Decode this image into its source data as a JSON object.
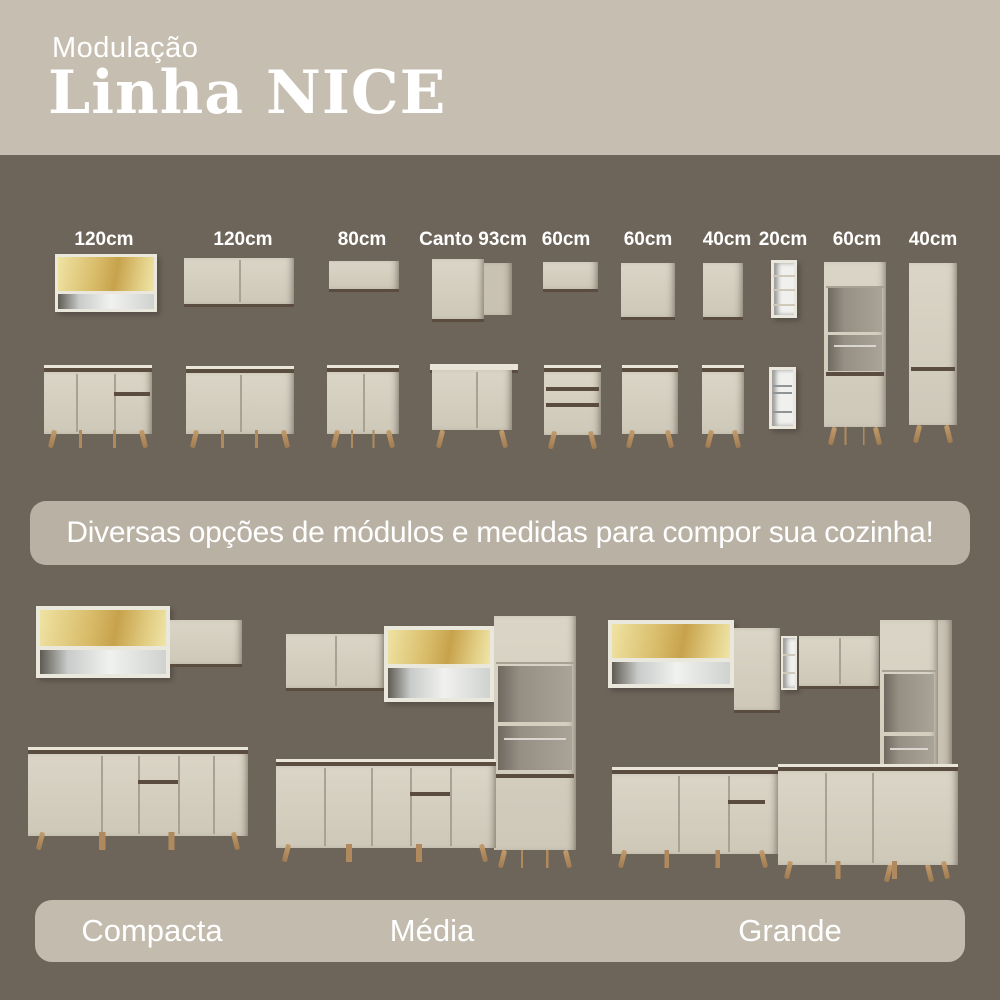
{
  "header": {
    "subtitle": "Modulação",
    "title": "Linha NICE"
  },
  "modules": {
    "items": [
      {
        "label": "120cm",
        "wall_unit": "glass-door-wall-cabinet-with-open-shelf",
        "base_unit": "counter-2-doors-drawer-door"
      },
      {
        "label": "120cm",
        "wall_unit": "wall-cabinet-2-doors",
        "base_unit": "counter-2-doors"
      },
      {
        "label": "80cm",
        "wall_unit": "wall-cabinet-flip-door",
        "base_unit": "counter-2-doors"
      },
      {
        "label": "Canto 93cm",
        "wall_unit": "corner-wall-cabinet",
        "base_unit": "corner-counter-cabinet"
      },
      {
        "label": "60cm",
        "wall_unit": "wall-cabinet-flip-door",
        "base_unit": "counter-3-drawers"
      },
      {
        "label": "60cm",
        "wall_unit": "wall-cabinet-1-door",
        "base_unit": "counter-1-door"
      },
      {
        "label": "40cm",
        "wall_unit": "wall-cabinet-1-door",
        "base_unit": "counter-1-door"
      },
      {
        "label": "20cm",
        "wall_unit": "open-niche-column",
        "base_unit": "bottle-rack-column"
      },
      {
        "label": "60cm",
        "tall_unit": "oven-tower-2-doors-2-niches"
      },
      {
        "label": "40cm",
        "tall_unit": "pantry-tower-2-doors"
      }
    ]
  },
  "banner": {
    "text": "Diversas opções de módulos e medidas para compor sua cozinha!"
  },
  "kitchens": {
    "items": [
      {
        "name": "Compacta"
      },
      {
        "name": "Média"
      },
      {
        "name": "Grande"
      }
    ]
  },
  "colors": {
    "background": "#6E655A",
    "header_bg": "#C6BFB1",
    "banner_bg": "#B9B1A4",
    "bar_bg": "#C3BCAE",
    "cabinet": "#D8D2C4",
    "dark_trim": "#5A4C3E",
    "glass_amber": "#D9BC68",
    "leg_wood": "#B08A5E",
    "text": "#FFFFFF"
  }
}
